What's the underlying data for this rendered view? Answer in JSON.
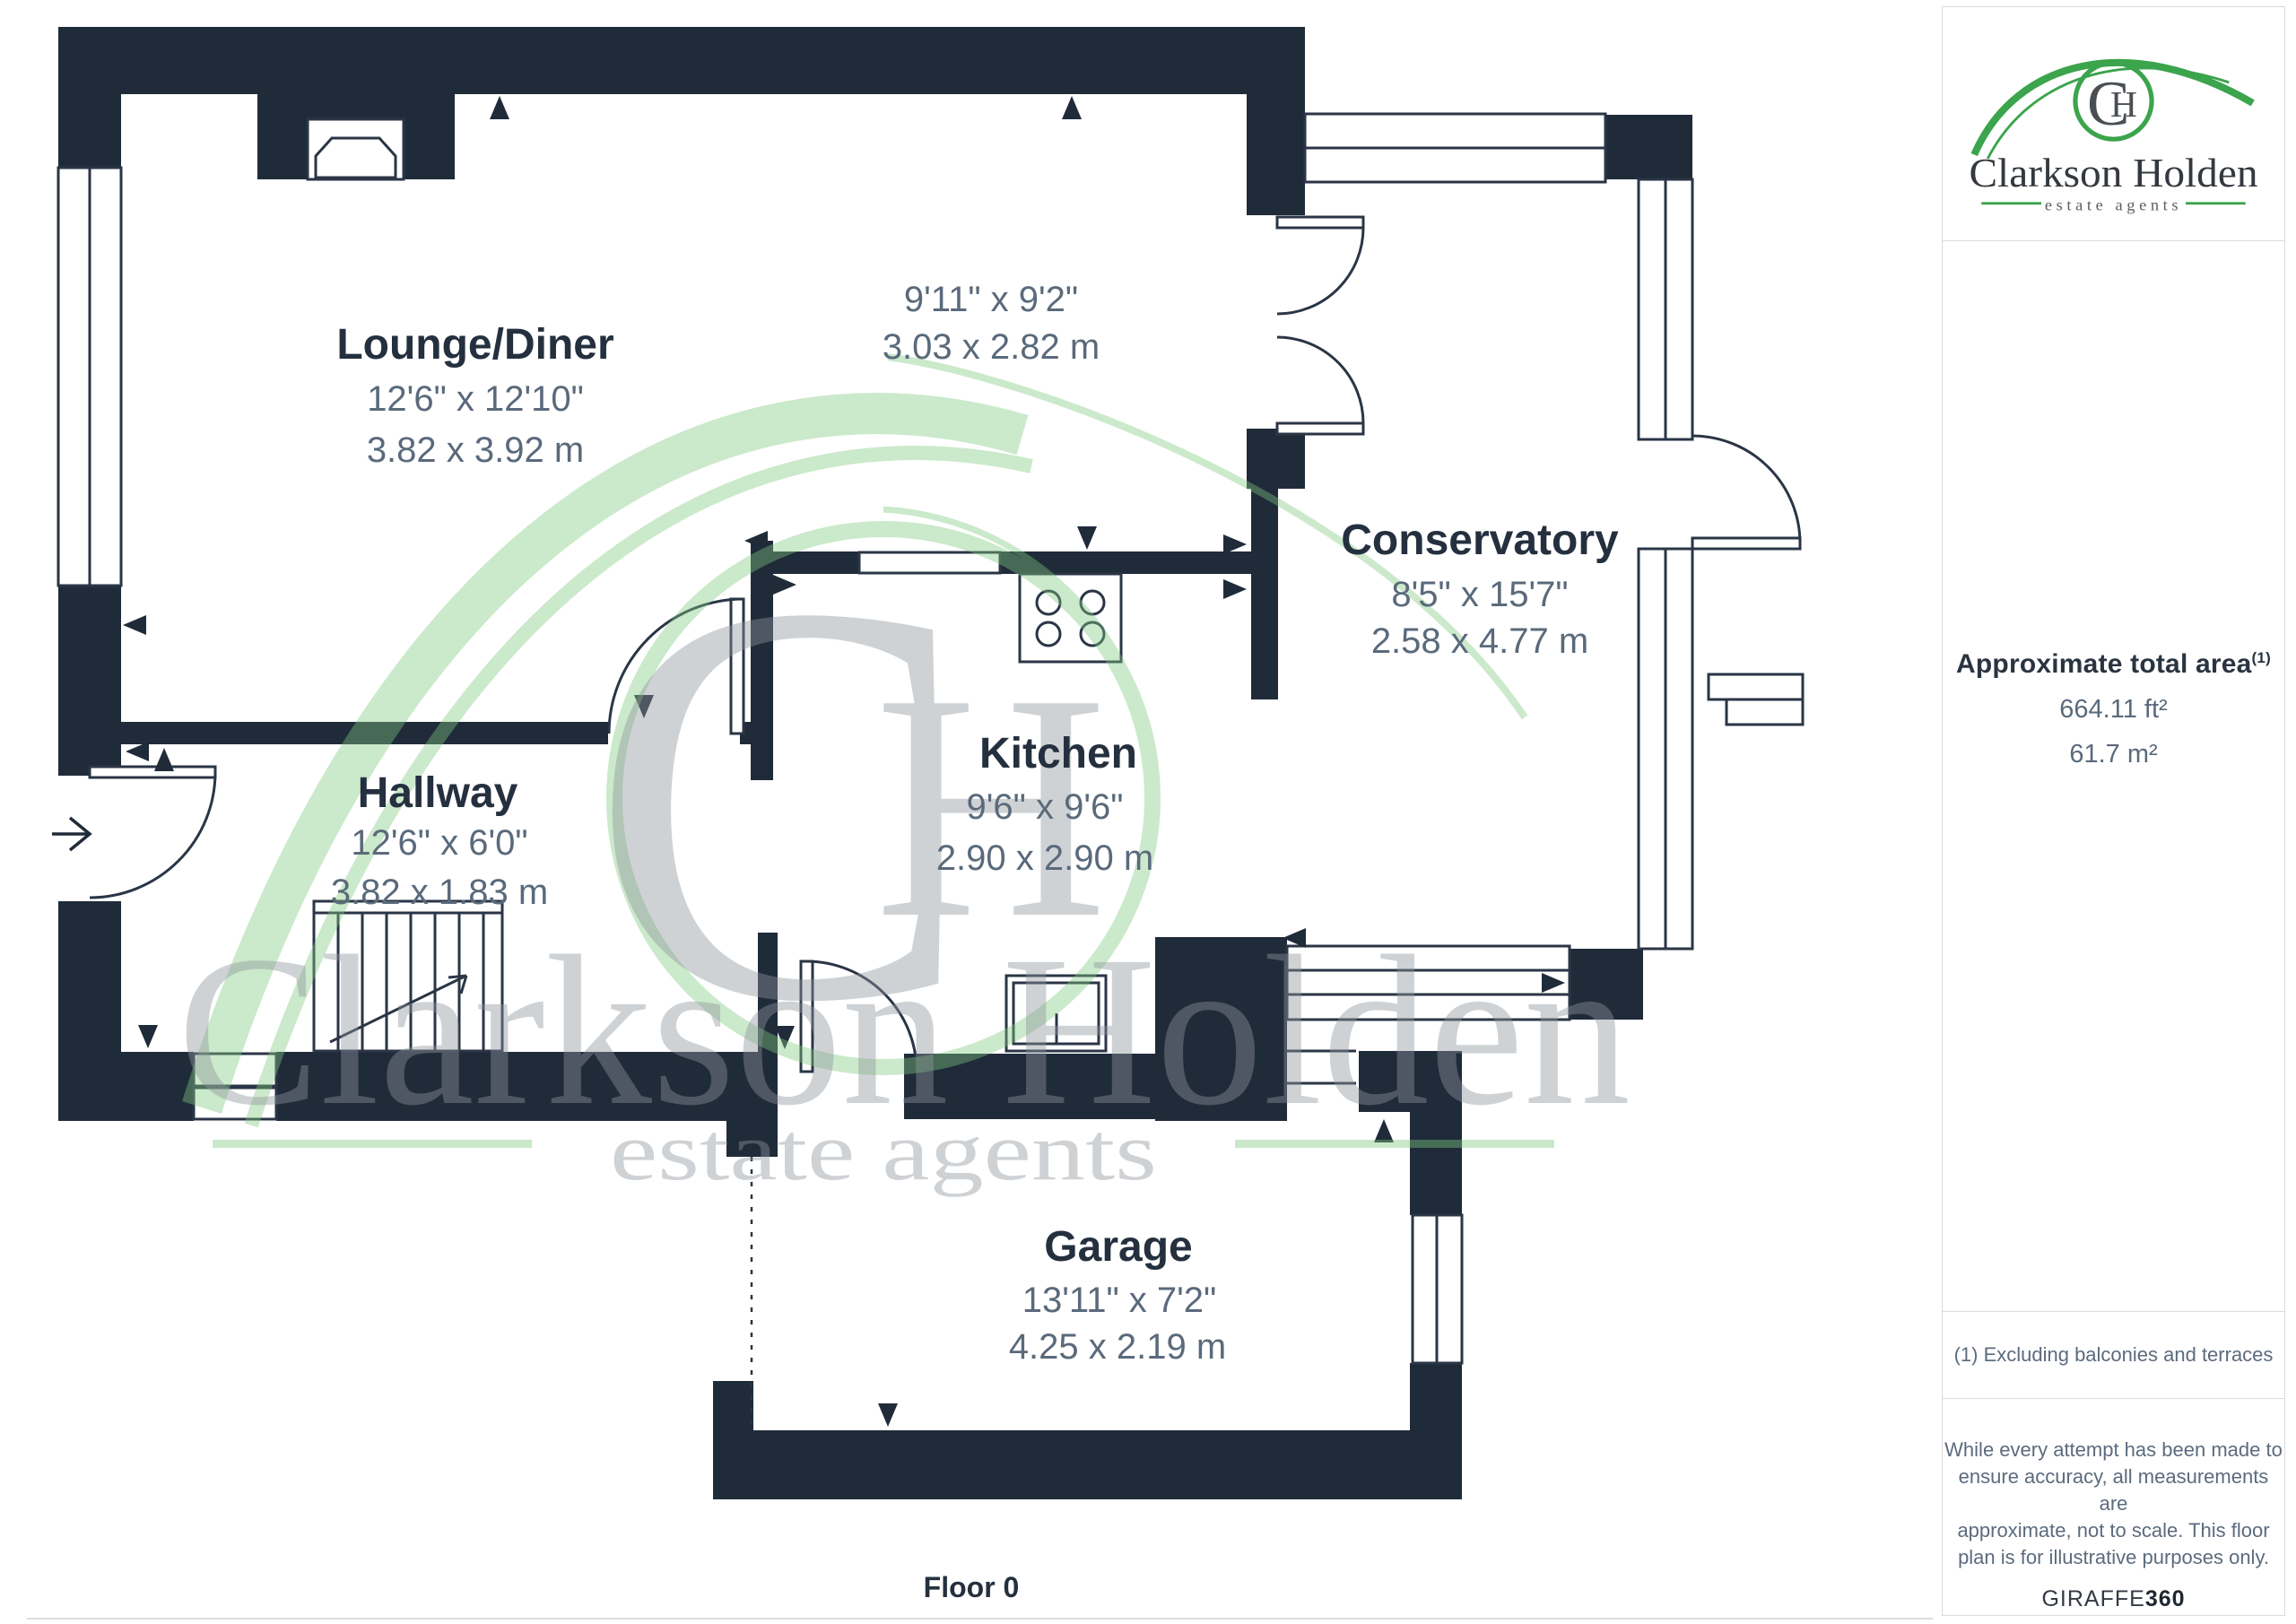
{
  "floor_plan": {
    "floor_label": "Floor 0",
    "rooms": [
      {
        "name": "Lounge/Diner",
        "imperial": "12'6\" x 12'10\"",
        "metric": "3.82 x 3.92 m"
      },
      {
        "name": "",
        "imperial": "9'11\" x 9'2\"",
        "metric": "3.03 x 2.82 m"
      },
      {
        "name": "Kitchen",
        "imperial": "9'6\" x 9'6\"",
        "metric": "2.90 x 2.90 m"
      },
      {
        "name": "Conservatory",
        "imperial": "8'5\" x 15'7\"",
        "metric": "2.58 x 4.77 m"
      },
      {
        "name": "Hallway",
        "imperial": "12'6\" x 6'0\"",
        "metric": "3.82 x 1.83 m"
      },
      {
        "name": "Garage",
        "imperial": "13'11\" x 7'2\"",
        "metric": "4.25 x 2.19 m"
      }
    ]
  },
  "watermark": {
    "name": "Clarkson Holden",
    "tagline": "estate agents",
    "monogram_c": "C",
    "monogram_h": "H"
  },
  "sidebar": {
    "brand": {
      "name": "Clarkson Holden",
      "tagline": "estate agents",
      "monogram_c": "C",
      "monogram_h": "H"
    },
    "area": {
      "title": "Approximate total area",
      "footnote_ref": "(1)",
      "imperial": "664.11 ft²",
      "metric": "61.7 m²"
    },
    "footnote": "(1) Excluding balconies and terraces",
    "disclaimer": [
      "While every attempt has been made to",
      "ensure accuracy, all measurements are",
      "approximate, not to scale. This floor",
      "plan is for illustrative purposes only."
    ],
    "credit": {
      "brand": "GIRAFFE",
      "suffix": "360"
    }
  },
  "colors": {
    "wall": "#202B3A",
    "room_text": "#25303F",
    "dimension_text": "#5A6A7B",
    "brand_green": "#3BA44C",
    "watermark_green": "#7FC97F",
    "watermark_gray": "#8E959C",
    "divider_gray": "#DBDBDB"
  }
}
